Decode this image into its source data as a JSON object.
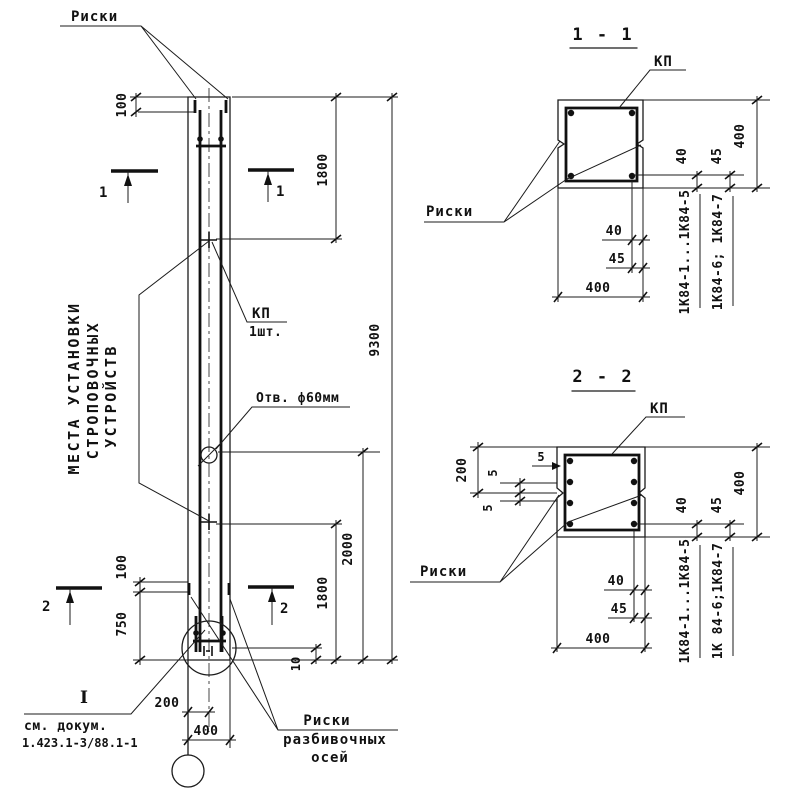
{
  "elevation": {
    "labels": {
      "riski": "Риски",
      "mesta1": "МЕСТА УСТАНОВКИ",
      "mesta2": "СТРОПОВОЧНЫХ",
      "mesta3": "УСТРОЙСТВ",
      "kp": "КП",
      "kp_qty": "1шт.",
      "hole": "Отв. ф60мм",
      "detail_mark": "I",
      "see_doc1": "см. докум.",
      "see_doc2": "1.423.1-3/88.1-1",
      "riski_axes1": "Риски",
      "riski_axes2": "разбивочных",
      "riski_axes3": "осей"
    },
    "dims": {
      "top_offset": "100",
      "top_span": "1800",
      "total": "9300",
      "hole_span": "2000",
      "bottom_span": "1800",
      "bottom_gap": "10",
      "bottom_offset": "100",
      "foot": "750",
      "axis_offset": "200",
      "width": "400"
    },
    "marks": {
      "s1": "1",
      "s2": "2"
    }
  },
  "section1": {
    "title": "1 - 1",
    "kp": "КП",
    "riski": "Риски",
    "dims": {
      "r40": "40",
      "r45": "45",
      "r400": "400",
      "b40": "40",
      "b45": "45",
      "b400": "400"
    },
    "series_a": "1К84-1...1К84-5",
    "series_b": "1К84-6; 1К84-7"
  },
  "section2": {
    "title": "2 - 2",
    "kp": "КП",
    "riski": "Риски",
    "dims": {
      "top": "200",
      "n5a": "5",
      "n5b": "5",
      "n5c": "5",
      "r40": "40",
      "r45": "45",
      "r400": "400",
      "b40": "40",
      "b45": "45",
      "b400": "400"
    },
    "series_a": "1К84-1...1К84-5",
    "series_b": "1К 84-6;1К84-7"
  },
  "colors": {
    "ink": "#1b1b1b",
    "paper": "#ffffff"
  }
}
